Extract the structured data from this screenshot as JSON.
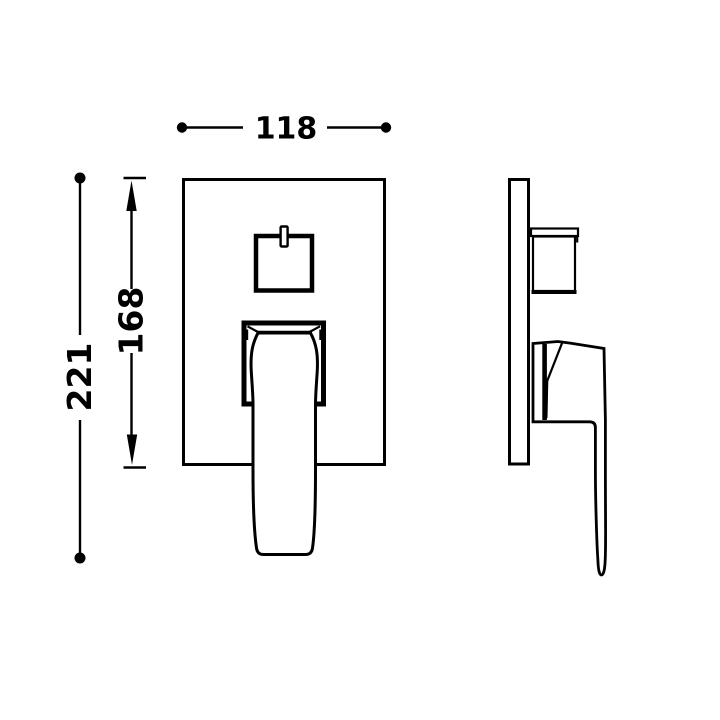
{
  "page": {
    "background_color": "#ffffff",
    "line_color": "#000000"
  },
  "drawing": {
    "dimensions": {
      "width": {
        "label": "118"
      },
      "plate_height": {
        "label": "168"
      },
      "overall_height": {
        "label": "221"
      }
    }
  }
}
